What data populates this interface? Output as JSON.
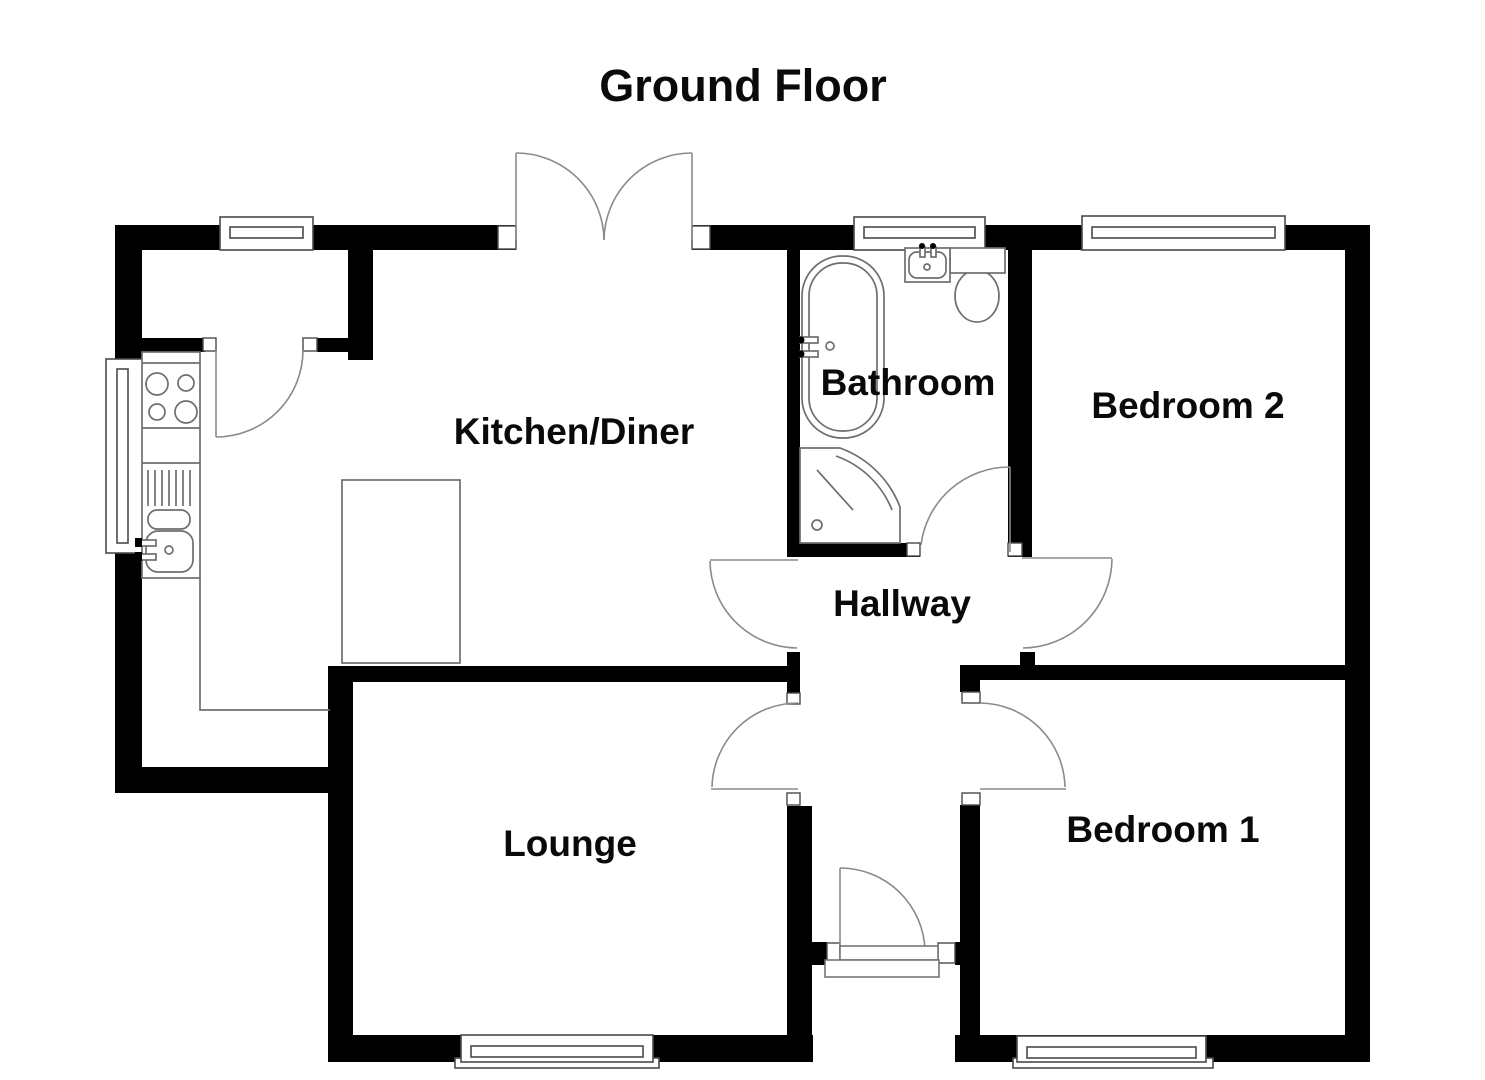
{
  "title": "Ground Floor",
  "rooms": [
    {
      "name": "Kitchen/Diner"
    },
    {
      "name": "Bathroom"
    },
    {
      "name": "Bedroom 2"
    },
    {
      "name": "Hallway"
    },
    {
      "name": "Lounge"
    },
    {
      "name": "Bedroom 1"
    }
  ],
  "colors": {
    "wall": "#000000",
    "background": "#ffffff",
    "door_line": "#8a8a8a",
    "fixture_line": "#6e6e6e",
    "window_line": "#4a4a4a",
    "text": "#0a0a0a"
  },
  "fixtures": [
    "hob",
    "worktop",
    "drainer",
    "kitchen-sink",
    "peninsula-unit",
    "bath",
    "bath-taps",
    "shower-enclosure",
    "wash-basin",
    "toilet",
    "front-door-threshold"
  ],
  "doors": [
    "store-door",
    "patio-double-doors",
    "kitchen-hallway-door",
    "bathroom-door",
    "bedroom2-door",
    "lounge-door",
    "bedroom1-door",
    "front-door"
  ],
  "windows": [
    "kitchen-window-top",
    "kitchen-window-left",
    "bathroom-window",
    "bedroom2-window",
    "lounge-window",
    "bedroom1-window"
  ]
}
